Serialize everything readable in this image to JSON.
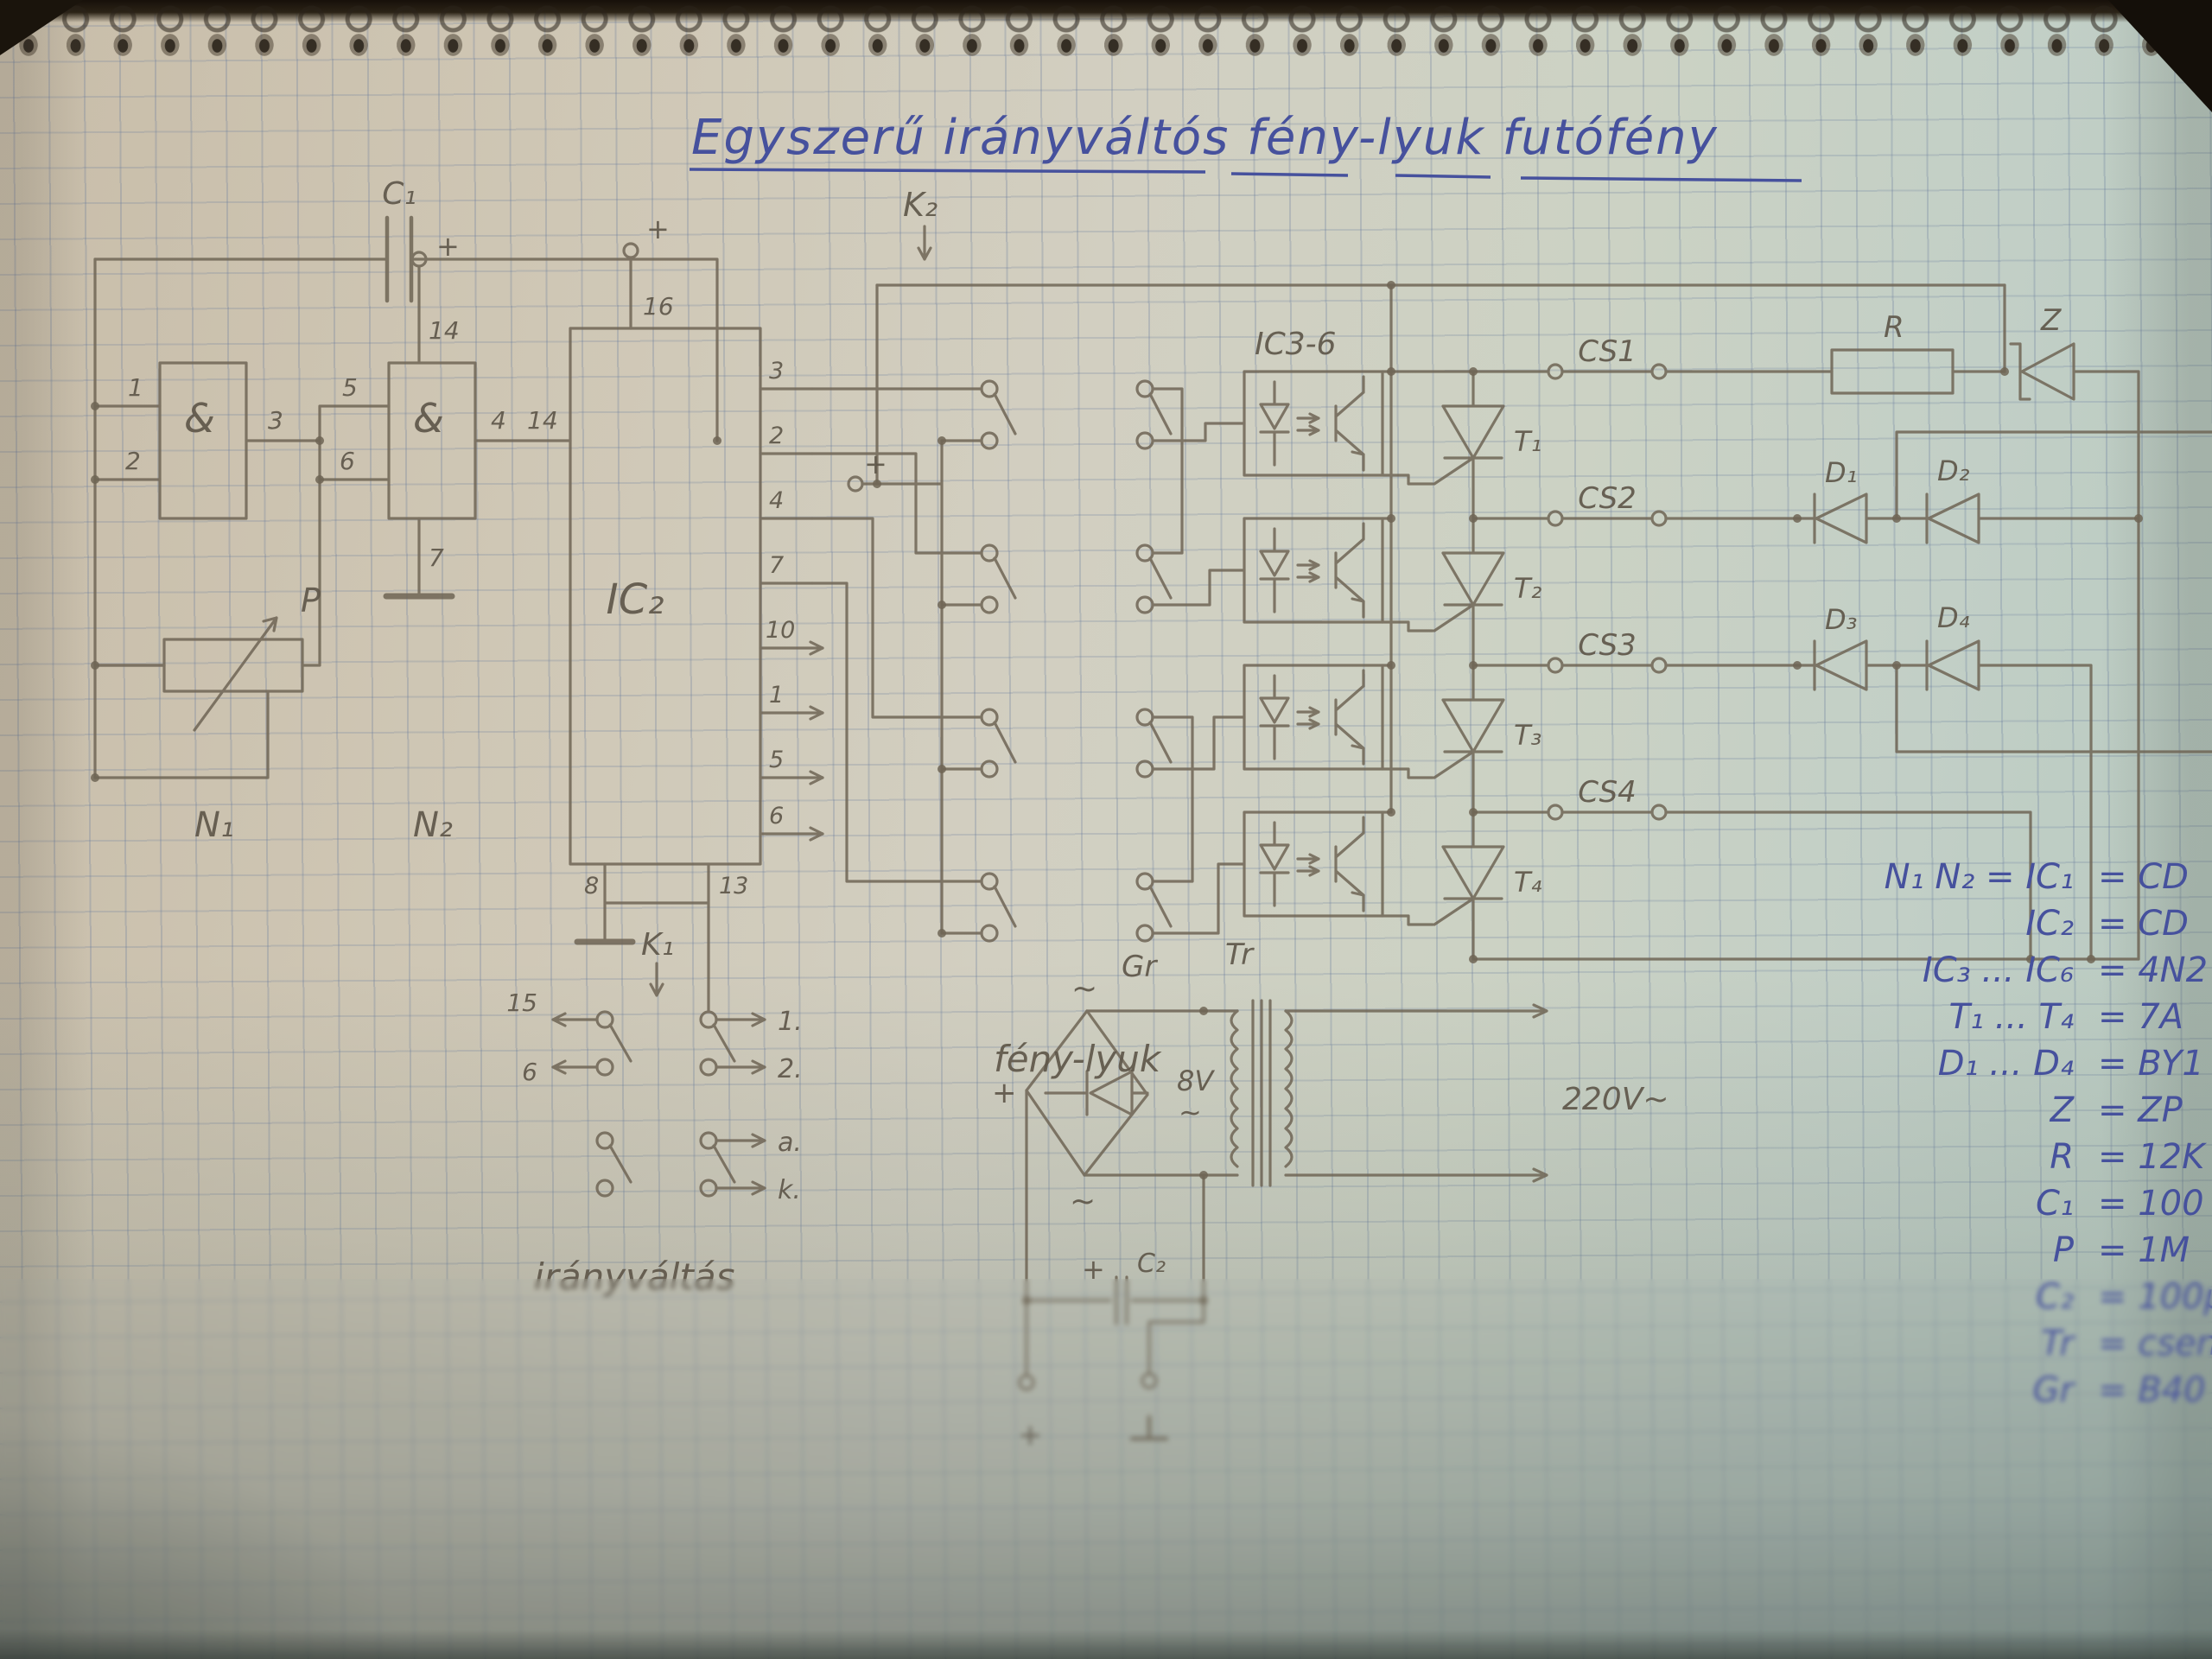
{
  "photo": {
    "title": "Egyszerű irányváltós fény-lyuk futófény"
  },
  "labels": {
    "feny_lyuk": "fény-lyuk",
    "iranyvaltas": "irányváltás"
  },
  "oscillator": {
    "c1": "C₁",
    "p": "P",
    "n1": "N₁",
    "n2": "N₂",
    "gate_symbol": "&",
    "pin1": "1",
    "pin2": "2",
    "pin3": "3",
    "pin4": "4",
    "pin5": "5",
    "pin6": "6",
    "pin7": "7",
    "pin14": "14",
    "plus": "+"
  },
  "ic2": {
    "label": "IC₂",
    "plus": "+",
    "pin16": "16",
    "pin14": "14",
    "pin8": "8",
    "pin13": "13",
    "right_pins": [
      "3",
      "2",
      "4",
      "7",
      "10",
      "1",
      "5",
      "6"
    ]
  },
  "k1": {
    "label": "K₁",
    "left1": "15",
    "left2": "6",
    "right1": "1.",
    "right2": "2.",
    "right3": "a.",
    "right4": "k."
  },
  "k2": {
    "label": "K₂",
    "plus": "+"
  },
  "opto": {
    "label": "IC3-6"
  },
  "thyristors": {
    "t1": "T₁",
    "t2": "T₂",
    "t3": "T₃",
    "t4": "T₄"
  },
  "outputs": {
    "cs1": "CS1",
    "cs2": "CS2",
    "cs3": "CS3",
    "cs4": "CS4"
  },
  "network": {
    "r": "R",
    "z": "Z",
    "d1": "D₁",
    "d2": "D₂",
    "d3": "D₃",
    "d4": "D₄"
  },
  "psu": {
    "gr": "Gr",
    "tr": "Tr",
    "v8": "8V",
    "tilde": "~",
    "v220": "220V~",
    "c2": "C₂",
    "plus": "+"
  },
  "parts_list": [
    {
      "name": "N₁  N₂ = IC₁",
      "value": "= CD"
    },
    {
      "name": "IC₂",
      "value": "= CD"
    },
    {
      "name": "IC₃ ... IC₆",
      "value": "= 4N2"
    },
    {
      "name": "T₁ ... T₄",
      "value": "= 7A"
    },
    {
      "name": "D₁ ... D₄",
      "value": "= BY1"
    },
    {
      "name": "Z",
      "value": "= ZP"
    },
    {
      "name": "R",
      "value": "= 12K"
    },
    {
      "name": "C₁",
      "value": "= 100"
    },
    {
      "name": "P",
      "value": "= 1M"
    },
    {
      "name": "C₂",
      "value": "= 100μ"
    },
    {
      "name": "Tr",
      "value": "= csen"
    },
    {
      "name": "Gr",
      "value": "= B40"
    }
  ]
}
